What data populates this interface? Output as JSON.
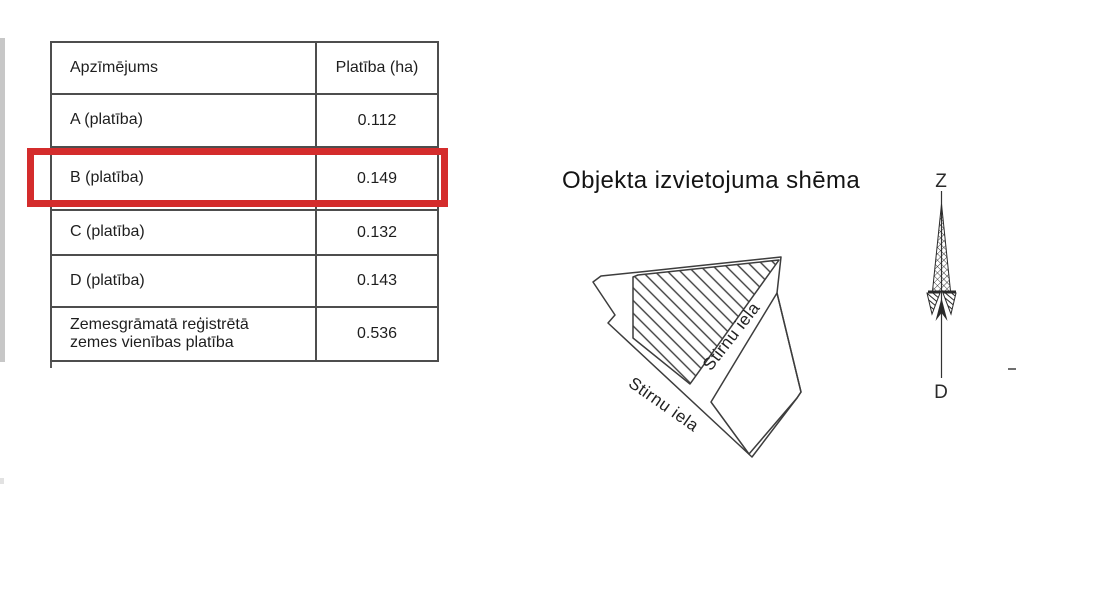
{
  "document": {
    "table": {
      "col_headers": [
        "Apzīmējums",
        "Platība (ha)"
      ],
      "rows": [
        {
          "label": "A (platība)",
          "value": "0.112"
        },
        {
          "label": "B (platība)",
          "value": "0.149"
        },
        {
          "label": "C (platība)",
          "value": "0.132"
        },
        {
          "label": "D (platība)",
          "value": "0.143"
        },
        {
          "label": "Zemesgrāmatā reģistrētā zemes vienības platība",
          "value": "0.536"
        }
      ],
      "highlighted_row_label": "B (platība)",
      "highlight_color": "#d42c2c"
    },
    "scheme": {
      "title": "Objekta izvietojuma shēma",
      "street_label_lower": "Stirnu iela",
      "street_label_middle": "Stirnu iela",
      "compass": {
        "north": "Z",
        "south": "D"
      }
    },
    "colors": {
      "line": "#3d3d3d",
      "table_border": "#4d4d4d",
      "text": "#1e1e1e"
    }
  }
}
